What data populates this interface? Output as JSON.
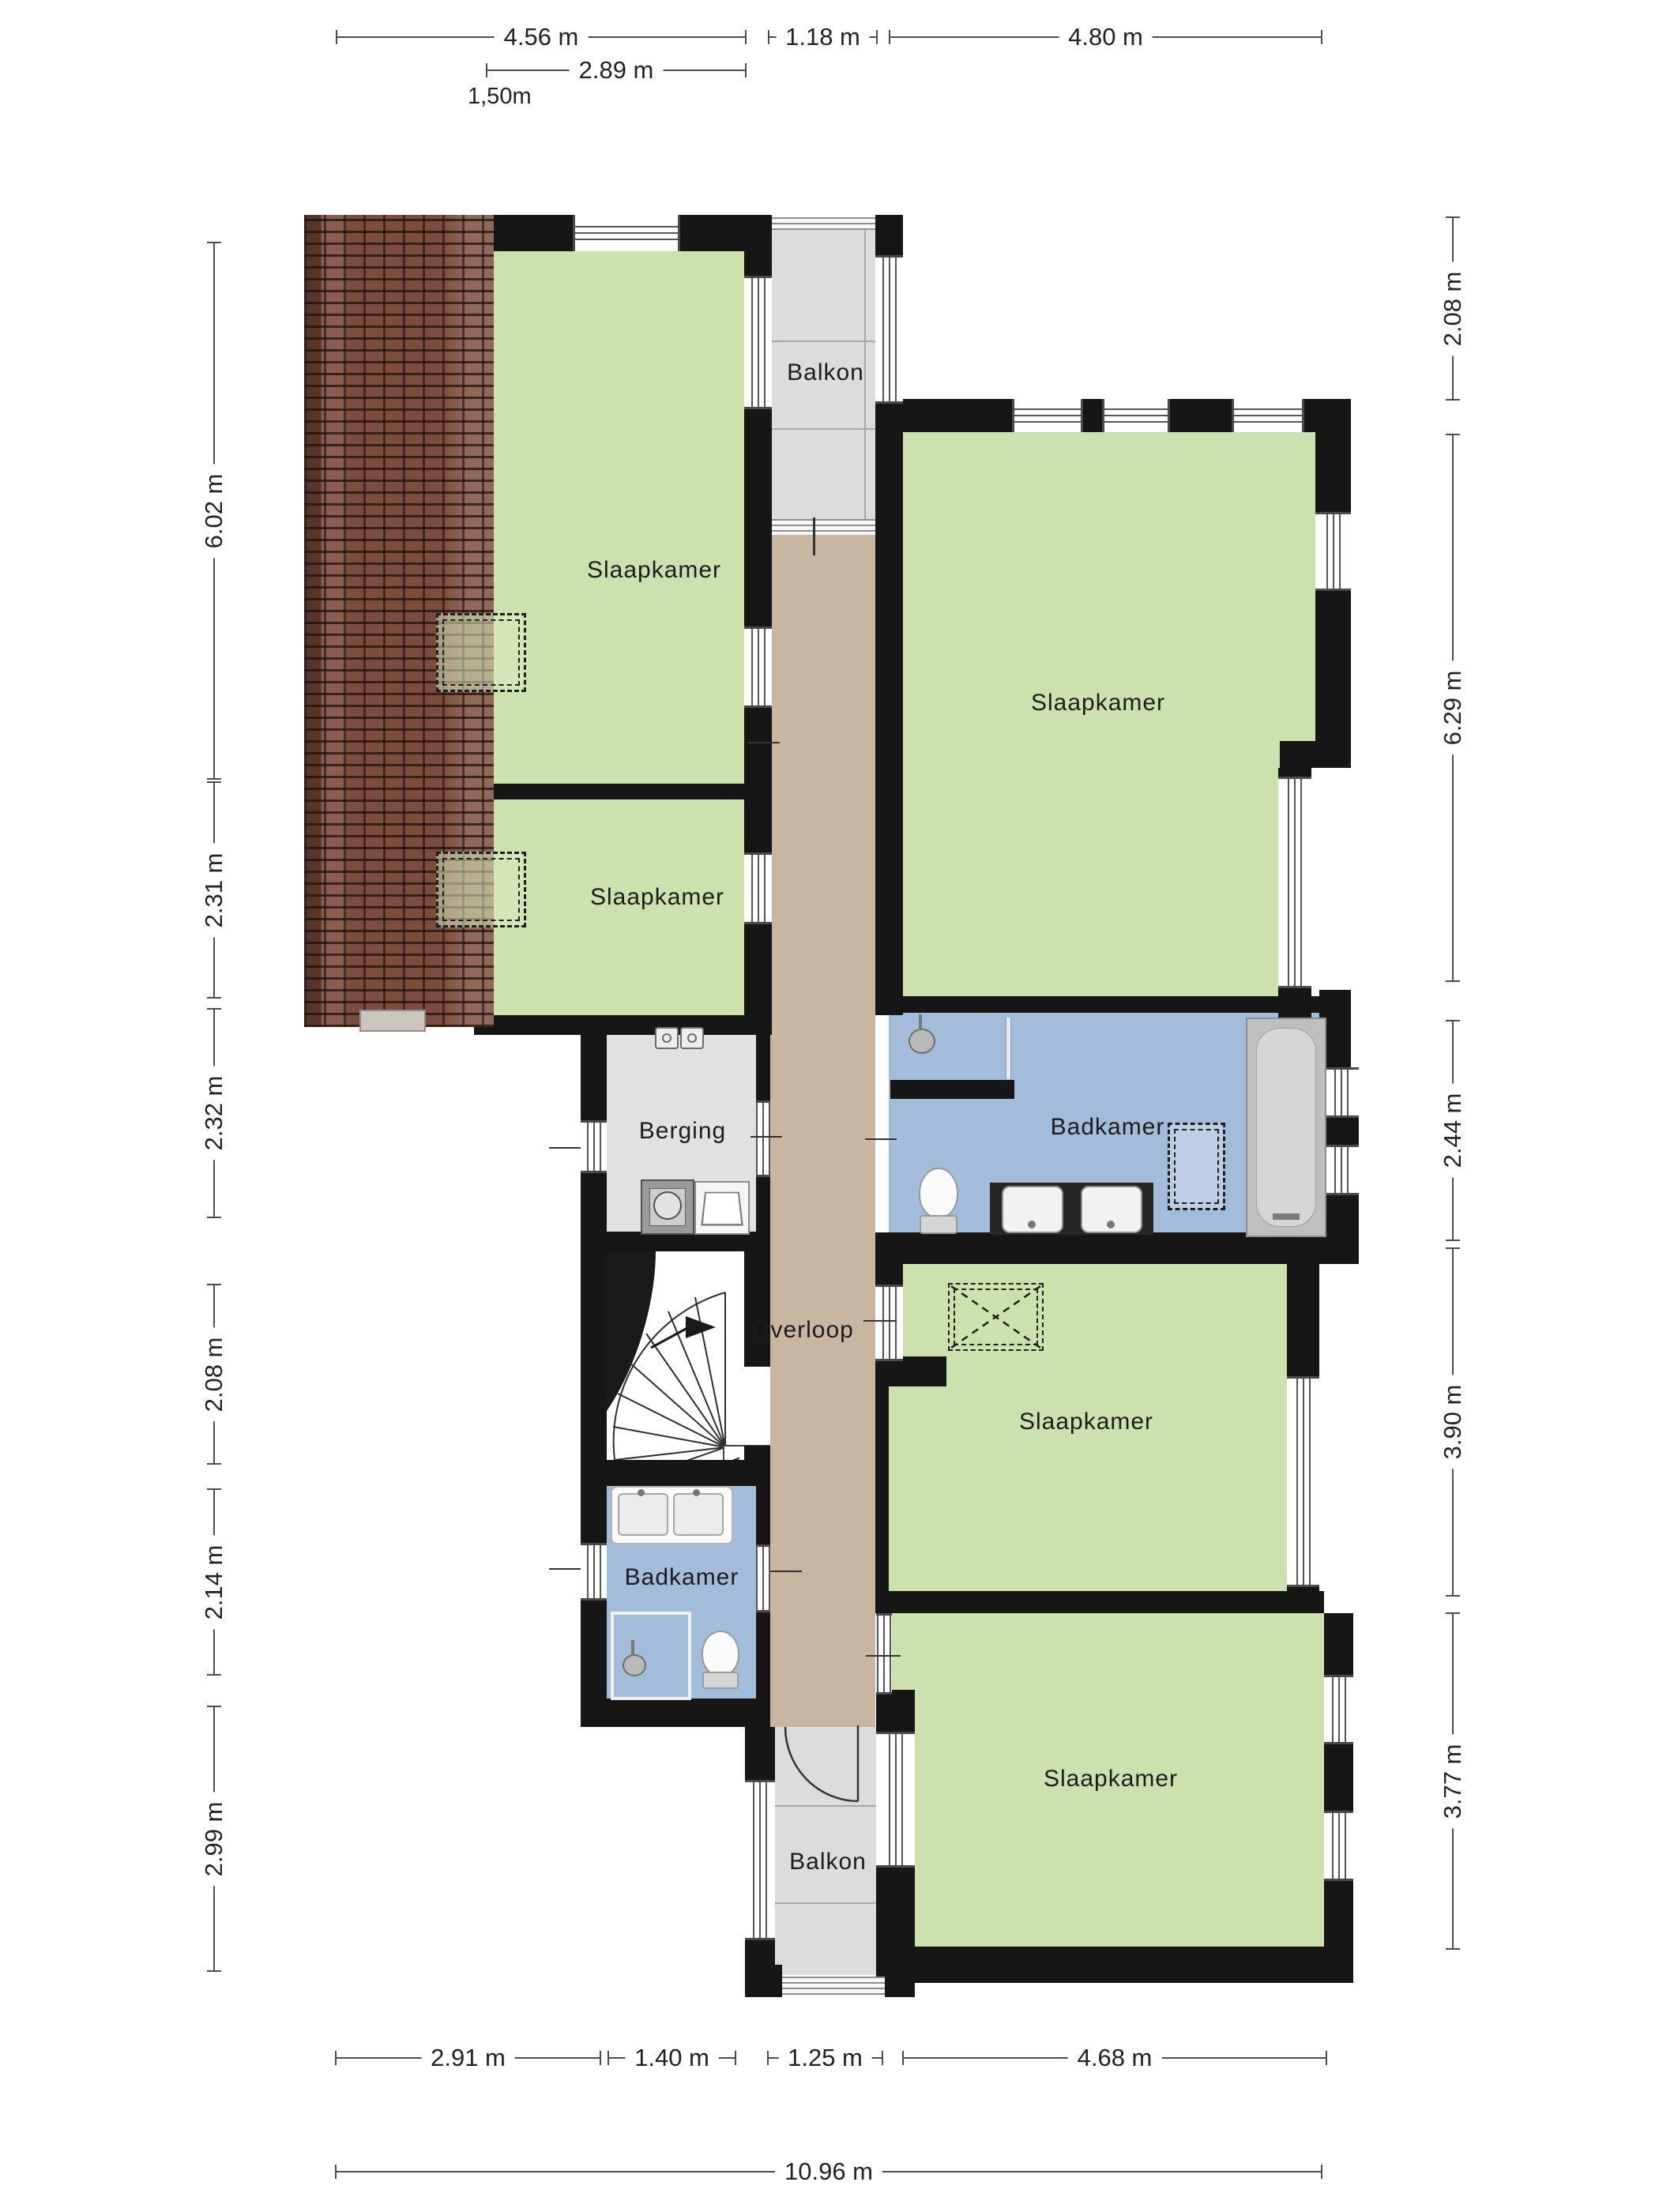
{
  "rooms": {
    "slaapkamer_top_left": "Slaapkamer",
    "slaapkamer_mid_left": "Slaapkamer",
    "slaapkamer_top_right": "Slaapkamer",
    "slaapkamer_mid_right": "Slaapkamer",
    "slaapkamer_bottom_right": "Slaapkamer",
    "balkon_top": "Balkon",
    "balkon_bottom": "Balkon",
    "badkamer_top": "Badkamer",
    "badkamer_bottom": "Badkamer",
    "berging": "Berging",
    "overloop": "Overloop"
  },
  "dims": {
    "top": [
      {
        "label": "4.56 m"
      },
      {
        "label": "1.18 m"
      },
      {
        "label": "4.80 m"
      }
    ],
    "top2": [
      {
        "label": "2.89 m"
      }
    ],
    "note": "1,50m",
    "left": [
      {
        "label": "6.02 m"
      },
      {
        "label": "2.31 m"
      },
      {
        "label": "2.32 m"
      },
      {
        "label": "2.08 m"
      },
      {
        "label": "2.14 m"
      },
      {
        "label": "2.99 m"
      }
    ],
    "right": [
      {
        "label": "2.08 m"
      },
      {
        "label": "6.29 m"
      },
      {
        "label": "2.44 m"
      },
      {
        "label": "3.90 m"
      },
      {
        "label": "3.77 m"
      }
    ],
    "bottom": [
      {
        "label": "2.91 m"
      },
      {
        "label": "1.40 m"
      },
      {
        "label": "1.25 m"
      },
      {
        "label": "4.68 m"
      }
    ],
    "bottom_total": "10.96 m"
  },
  "colors": {
    "wall": "#161616",
    "bedroom_fill": "#cbe2af",
    "corridor_fill": "#c8b6a3",
    "bathroom_fill": "#a3bcd9",
    "balcony_fill": "#dcdcdc",
    "storage_fill": "#e1e1e1",
    "roof_fill": "#7c4c3c",
    "dimension_line": "#4d4d4d"
  },
  "icons": {
    "bathtub": "bathtub-icon",
    "toilet": "toilet-icon",
    "sink": "sink-icon",
    "shower": "shower-head-icon",
    "washing_machine": "washing-machine-icon",
    "laundry_basket": "laundry-basket-icon",
    "spiral_stairs": "spiral-staircase-icon",
    "door_arc": "door-swing-arc",
    "skylight": "skylight-dashed-box"
  }
}
